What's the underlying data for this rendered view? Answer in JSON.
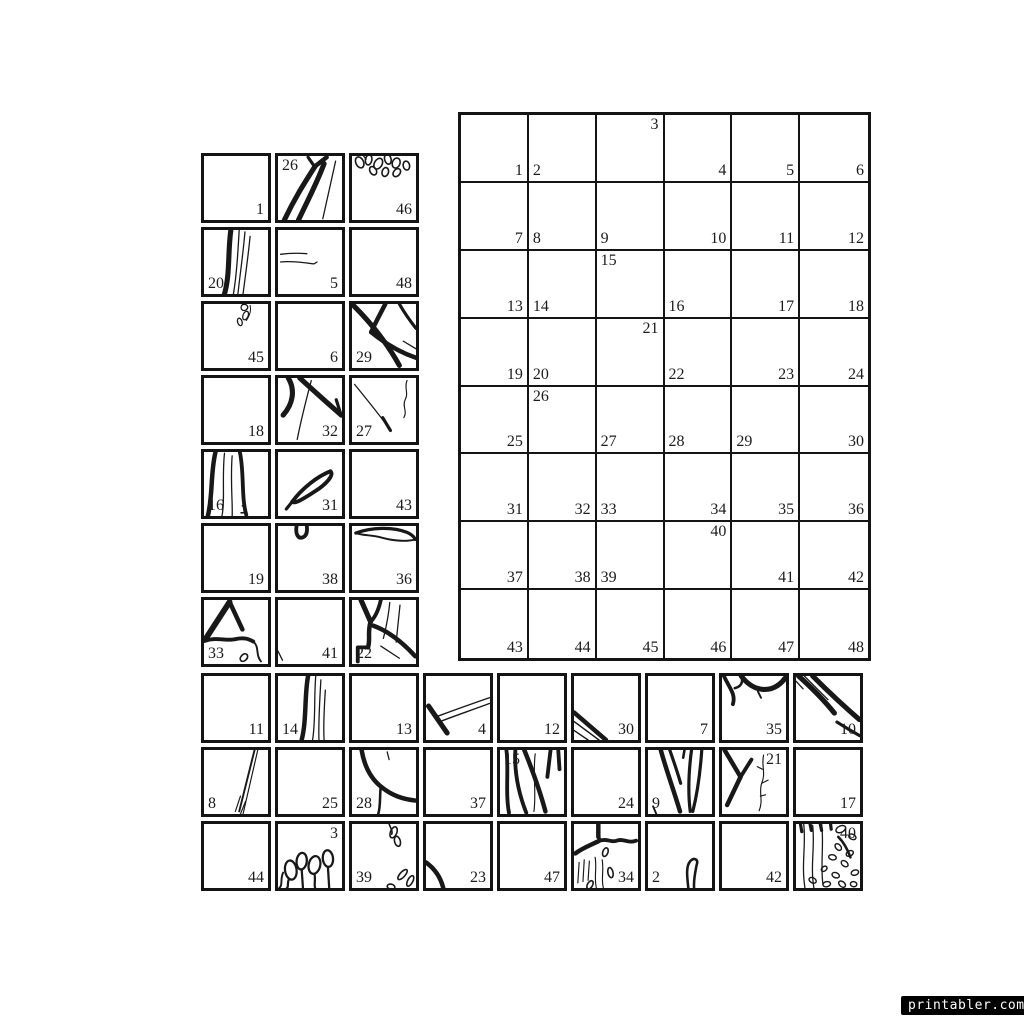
{
  "page": {
    "background": "#ffffff",
    "ink": "#181818"
  },
  "watermark": {
    "text": "printabler.com",
    "background": "#000000",
    "color": "#ffffff"
  },
  "main_grid": {
    "rows": 8,
    "cols": 6,
    "cells": [
      {
        "num": "1",
        "corner": "br"
      },
      {
        "num": "2",
        "corner": "bl"
      },
      {
        "num": "3",
        "corner": "tr"
      },
      {
        "num": "4",
        "corner": "br"
      },
      {
        "num": "5",
        "corner": "br"
      },
      {
        "num": "6",
        "corner": "br"
      },
      {
        "num": "7",
        "corner": "br"
      },
      {
        "num": "8",
        "corner": "bl"
      },
      {
        "num": "9",
        "corner": "bl"
      },
      {
        "num": "10",
        "corner": "br"
      },
      {
        "num": "11",
        "corner": "br"
      },
      {
        "num": "12",
        "corner": "br"
      },
      {
        "num": "13",
        "corner": "br"
      },
      {
        "num": "14",
        "corner": "bl"
      },
      {
        "num": "15",
        "corner": "tl"
      },
      {
        "num": "16",
        "corner": "bl"
      },
      {
        "num": "17",
        "corner": "br"
      },
      {
        "num": "18",
        "corner": "br"
      },
      {
        "num": "19",
        "corner": "br"
      },
      {
        "num": "20",
        "corner": "bl"
      },
      {
        "num": "21",
        "corner": "tr"
      },
      {
        "num": "22",
        "corner": "bl"
      },
      {
        "num": "23",
        "corner": "br"
      },
      {
        "num": "24",
        "corner": "br"
      },
      {
        "num": "25",
        "corner": "br"
      },
      {
        "num": "26",
        "corner": "tl"
      },
      {
        "num": "27",
        "corner": "bl"
      },
      {
        "num": "28",
        "corner": "bl"
      },
      {
        "num": "29",
        "corner": "bl"
      },
      {
        "num": "30",
        "corner": "br"
      },
      {
        "num": "31",
        "corner": "br"
      },
      {
        "num": "32",
        "corner": "br"
      },
      {
        "num": "33",
        "corner": "bl"
      },
      {
        "num": "34",
        "corner": "br"
      },
      {
        "num": "35",
        "corner": "br"
      },
      {
        "num": "36",
        "corner": "br"
      },
      {
        "num": "37",
        "corner": "br"
      },
      {
        "num": "38",
        "corner": "br"
      },
      {
        "num": "39",
        "corner": "bl"
      },
      {
        "num": "40",
        "corner": "tr"
      },
      {
        "num": "41",
        "corner": "br"
      },
      {
        "num": "42",
        "corner": "br"
      },
      {
        "num": "43",
        "corner": "br"
      },
      {
        "num": "44",
        "corner": "br"
      },
      {
        "num": "45",
        "corner": "br"
      },
      {
        "num": "46",
        "corner": "br"
      },
      {
        "num": "47",
        "corner": "br"
      },
      {
        "num": "48",
        "corner": "br"
      }
    ]
  },
  "left_tiles": {
    "cols": 3,
    "tiles": [
      {
        "num": "1",
        "corner": "br",
        "art": "blank"
      },
      {
        "num": "26",
        "corner": "tl",
        "art": "forked_branch"
      },
      {
        "num": "46",
        "corner": "br",
        "art": "leaf_cluster_top"
      },
      {
        "num": "20",
        "corner": "bl",
        "art": "vertical_stem"
      },
      {
        "num": "5",
        "corner": "br",
        "art": "whisker_lines"
      },
      {
        "num": "48",
        "corner": "br",
        "art": "blank"
      },
      {
        "num": "45",
        "corner": "br",
        "art": "sprig_top"
      },
      {
        "num": "6",
        "corner": "br",
        "art": "blank"
      },
      {
        "num": "29",
        "corner": "bl",
        "art": "diagonal_branches"
      },
      {
        "num": "18",
        "corner": "br",
        "art": "blank"
      },
      {
        "num": "32",
        "corner": "br",
        "art": "branches_from_top"
      },
      {
        "num": "27",
        "corner": "bl",
        "art": "thin_diag_squiggle"
      },
      {
        "num": "16",
        "corner": "bl",
        "art": "curved_stems"
      },
      {
        "num": "31",
        "corner": "br",
        "art": "pod_leaf"
      },
      {
        "num": "43",
        "corner": "br",
        "art": "blank"
      },
      {
        "num": "19",
        "corner": "br",
        "art": "blank"
      },
      {
        "num": "38",
        "corner": "br",
        "art": "notch_top"
      },
      {
        "num": "36",
        "corner": "br",
        "art": "branch_along_top"
      },
      {
        "num": "33",
        "corner": "bl",
        "art": "a_frame_branch"
      },
      {
        "num": "41",
        "corner": "br",
        "art": "edge_tick"
      },
      {
        "num": "22",
        "corner": "bl",
        "art": "branch_junction"
      }
    ]
  },
  "bottom_tiles": {
    "cols": 9,
    "tiles": [
      {
        "num": "11",
        "corner": "br",
        "art": "blank"
      },
      {
        "num": "14",
        "corner": "bl",
        "art": "stem_with_lines"
      },
      {
        "num": "13",
        "corner": "br",
        "art": "blank"
      },
      {
        "num": "4",
        "corner": "br",
        "art": "sweeping_curve"
      },
      {
        "num": "12",
        "corner": "br",
        "art": "blank"
      },
      {
        "num": "30",
        "corner": "br",
        "art": "diagonal_lines_corner"
      },
      {
        "num": "7",
        "corner": "br",
        "art": "blank"
      },
      {
        "num": "35",
        "corner": "br",
        "art": "wavy_branch_top"
      },
      {
        "num": "10",
        "corner": "br",
        "art": "crossing_diagonals"
      },
      {
        "num": "8",
        "corner": "bl",
        "art": "thin_diag_right"
      },
      {
        "num": "25",
        "corner": "br",
        "art": "blank"
      },
      {
        "num": "28",
        "corner": "bl",
        "art": "big_curve"
      },
      {
        "num": "37",
        "corner": "br",
        "art": "blank"
      },
      {
        "num": "15",
        "corner": "tl",
        "art": "multi_stems"
      },
      {
        "num": "24",
        "corner": "br",
        "art": "blank"
      },
      {
        "num": "9",
        "corner": "bl",
        "art": "vertical_branches"
      },
      {
        "num": "21",
        "corner": "tr",
        "art": "branch_and_squiggle"
      },
      {
        "num": "17",
        "corner": "br",
        "art": "blank"
      },
      {
        "num": "44",
        "corner": "br",
        "art": "blank"
      },
      {
        "num": "3",
        "corner": "tr",
        "art": "bud_cluster"
      },
      {
        "num": "39",
        "corner": "bl",
        "art": "corner_leaves"
      },
      {
        "num": "23",
        "corner": "br",
        "art": "corner_arc"
      },
      {
        "num": "47",
        "corner": "br",
        "art": "blank"
      },
      {
        "num": "34",
        "corner": "br",
        "art": "curve_with_hatching"
      },
      {
        "num": "2",
        "corner": "bl",
        "art": "hook_curve"
      },
      {
        "num": "42",
        "corner": "br",
        "art": "blank"
      },
      {
        "num": "40",
        "corner": "tr",
        "art": "berry_texture"
      }
    ]
  }
}
